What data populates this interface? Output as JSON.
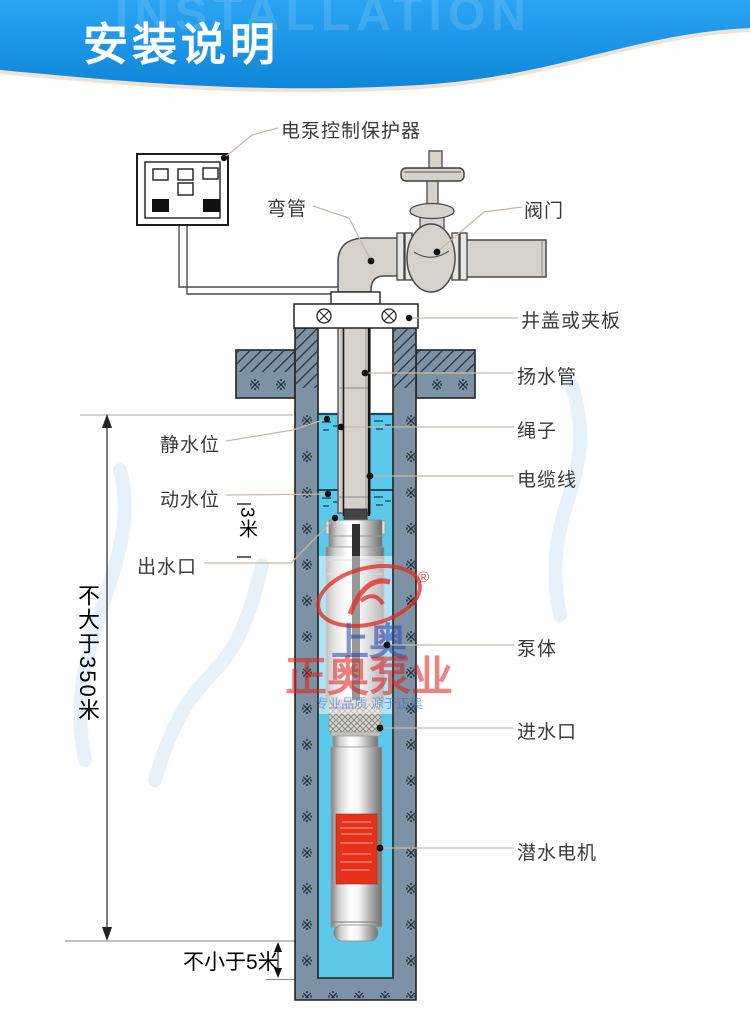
{
  "header": {
    "title": "安装说明",
    "watermark_text": "INSTALLATION"
  },
  "labels": {
    "controller": "电泵控制保护器",
    "elbow": "弯管",
    "valve": "阀门",
    "well_cover": "井盖或夹板",
    "riser_pipe": "扬水管",
    "rope": "绳子",
    "cable": "电缆线",
    "static_level": "静水位",
    "dynamic_level": "动水位",
    "outlet": "出水口",
    "pump_body": "泵体",
    "inlet": "进水口",
    "motor": "潜水电机"
  },
  "dimensions": {
    "max_depth": "不大于350米",
    "min_submergence": "3米",
    "min_bottom_clearance": "不小于5米"
  },
  "brand_watermark": {
    "name_cn": "上奥",
    "company": "正奥泵业",
    "tagline": "专业品质 源于正奥",
    "registered_mark": "®"
  },
  "decorations": {
    "masonry_symbol": "※"
  },
  "colors": {
    "banner_blue": "#1e96e6",
    "wall_gray": "#7d93a5",
    "water_cyan": "#5cc8ea",
    "pipe_gray": "#d6d2cb",
    "motor_label_red": "#e5311a"
  }
}
